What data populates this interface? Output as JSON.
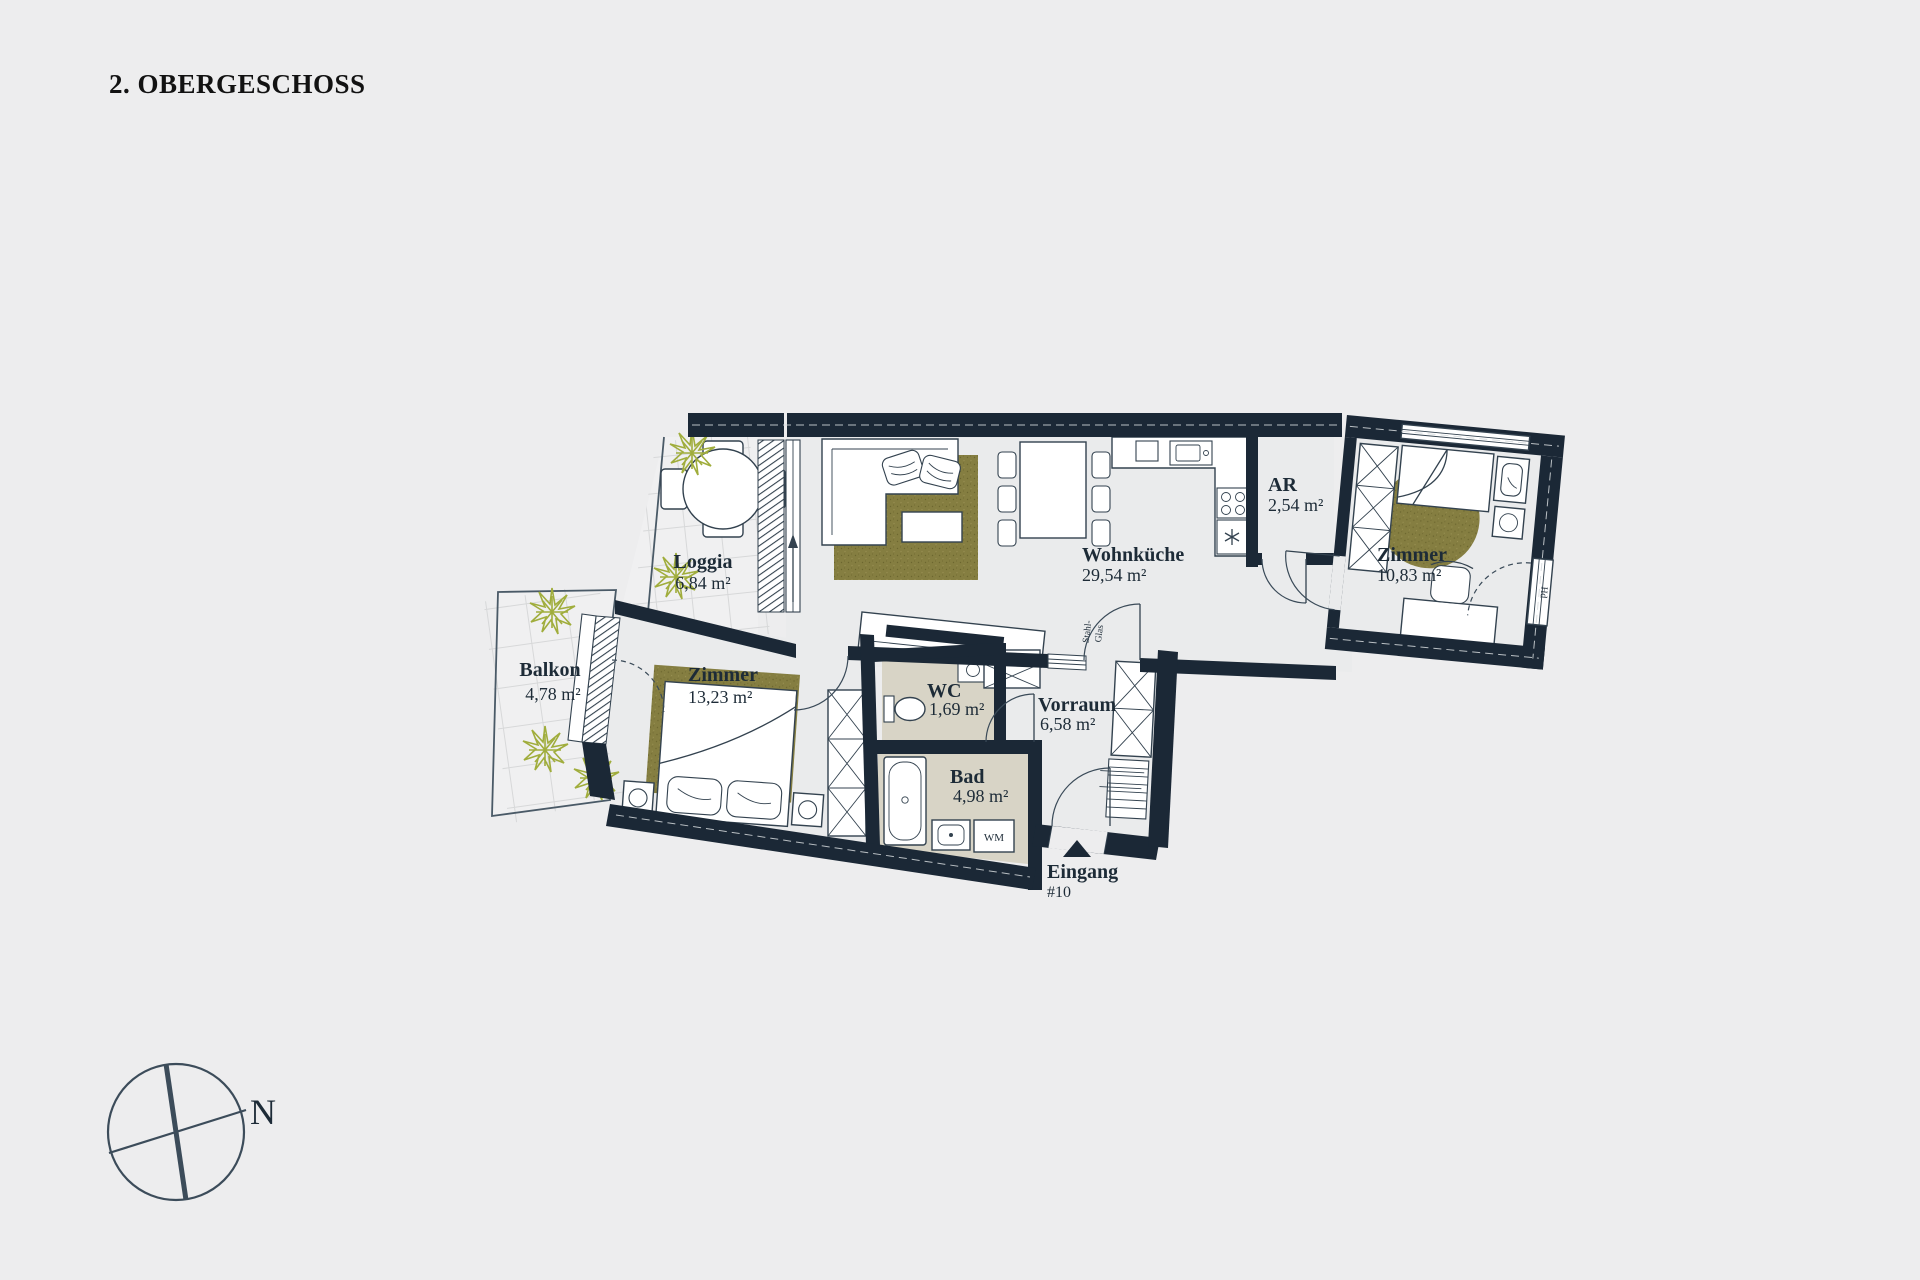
{
  "title": "2. OBERGESCHOSS",
  "floor_plan": {
    "rooms": [
      {
        "name": "Loggia",
        "area": "6,84 m²"
      },
      {
        "name": "Balkon",
        "area": "4,78 m²"
      },
      {
        "name": "Zimmer",
        "area": "13,23 m²"
      },
      {
        "name": "WC",
        "area": "1,69 m²"
      },
      {
        "name": "Bad",
        "area": "4,98 m²"
      },
      {
        "name": "Vorraum",
        "area": "6,58 m²"
      },
      {
        "name": "Wohnküche",
        "area": "29,54 m²"
      },
      {
        "name": "AR",
        "area": "2,54 m²"
      },
      {
        "name": "Zimmer",
        "area": "10,83 m²"
      }
    ],
    "entrance": {
      "label": "Eingang",
      "unit_number": "#10"
    },
    "annotations": {
      "distribution_box": "VERTEILER",
      "glass_partition_line1": "Stahl-",
      "glass_partition_line2": "Glas",
      "washing_machine": "WM",
      "radiator": "Hd"
    },
    "compass": {
      "north_label": "N"
    },
    "colors": {
      "walls": "#1b2836",
      "rug_olive": "#857e41",
      "wet_room_floor": "#d8d4c6",
      "background": "#ededee",
      "plant_green": "#a0ad3c"
    }
  }
}
